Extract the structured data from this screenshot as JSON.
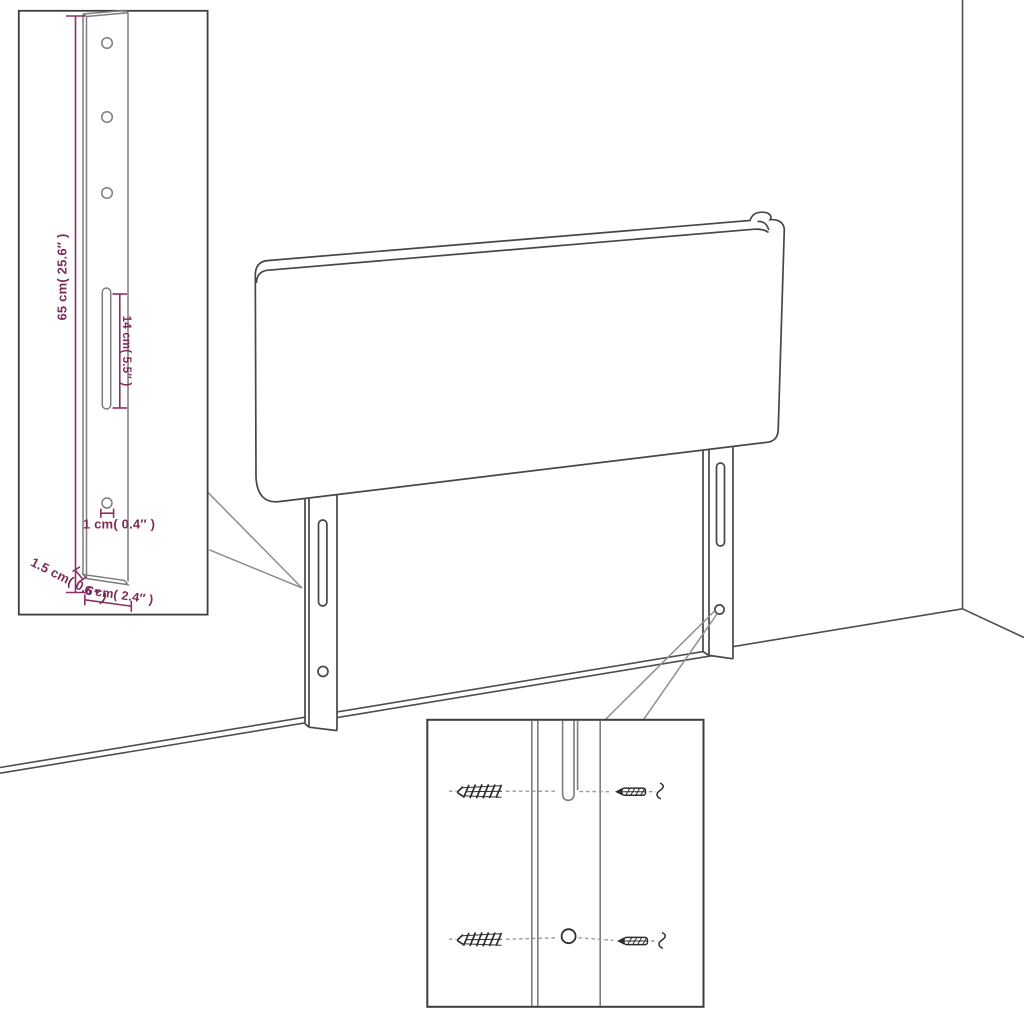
{
  "colors": {
    "dimension_accent": "#8a3066",
    "label_text": "#7d2b58",
    "figure_line": "#474747",
    "inset_line": "#7d7d7d",
    "hardware_line": "#2e2e2e",
    "background": "#ffffff"
  },
  "labels": {
    "leg_height": "65 cm( 25.6″ )",
    "slot_length": "14 cm( 5.5″ )",
    "hole_size": "1 cm( 0.4″ )",
    "leg_thickness": "1.5 cm( 0.6″ )",
    "leg_width": "6 cm( 2.4″ )"
  }
}
